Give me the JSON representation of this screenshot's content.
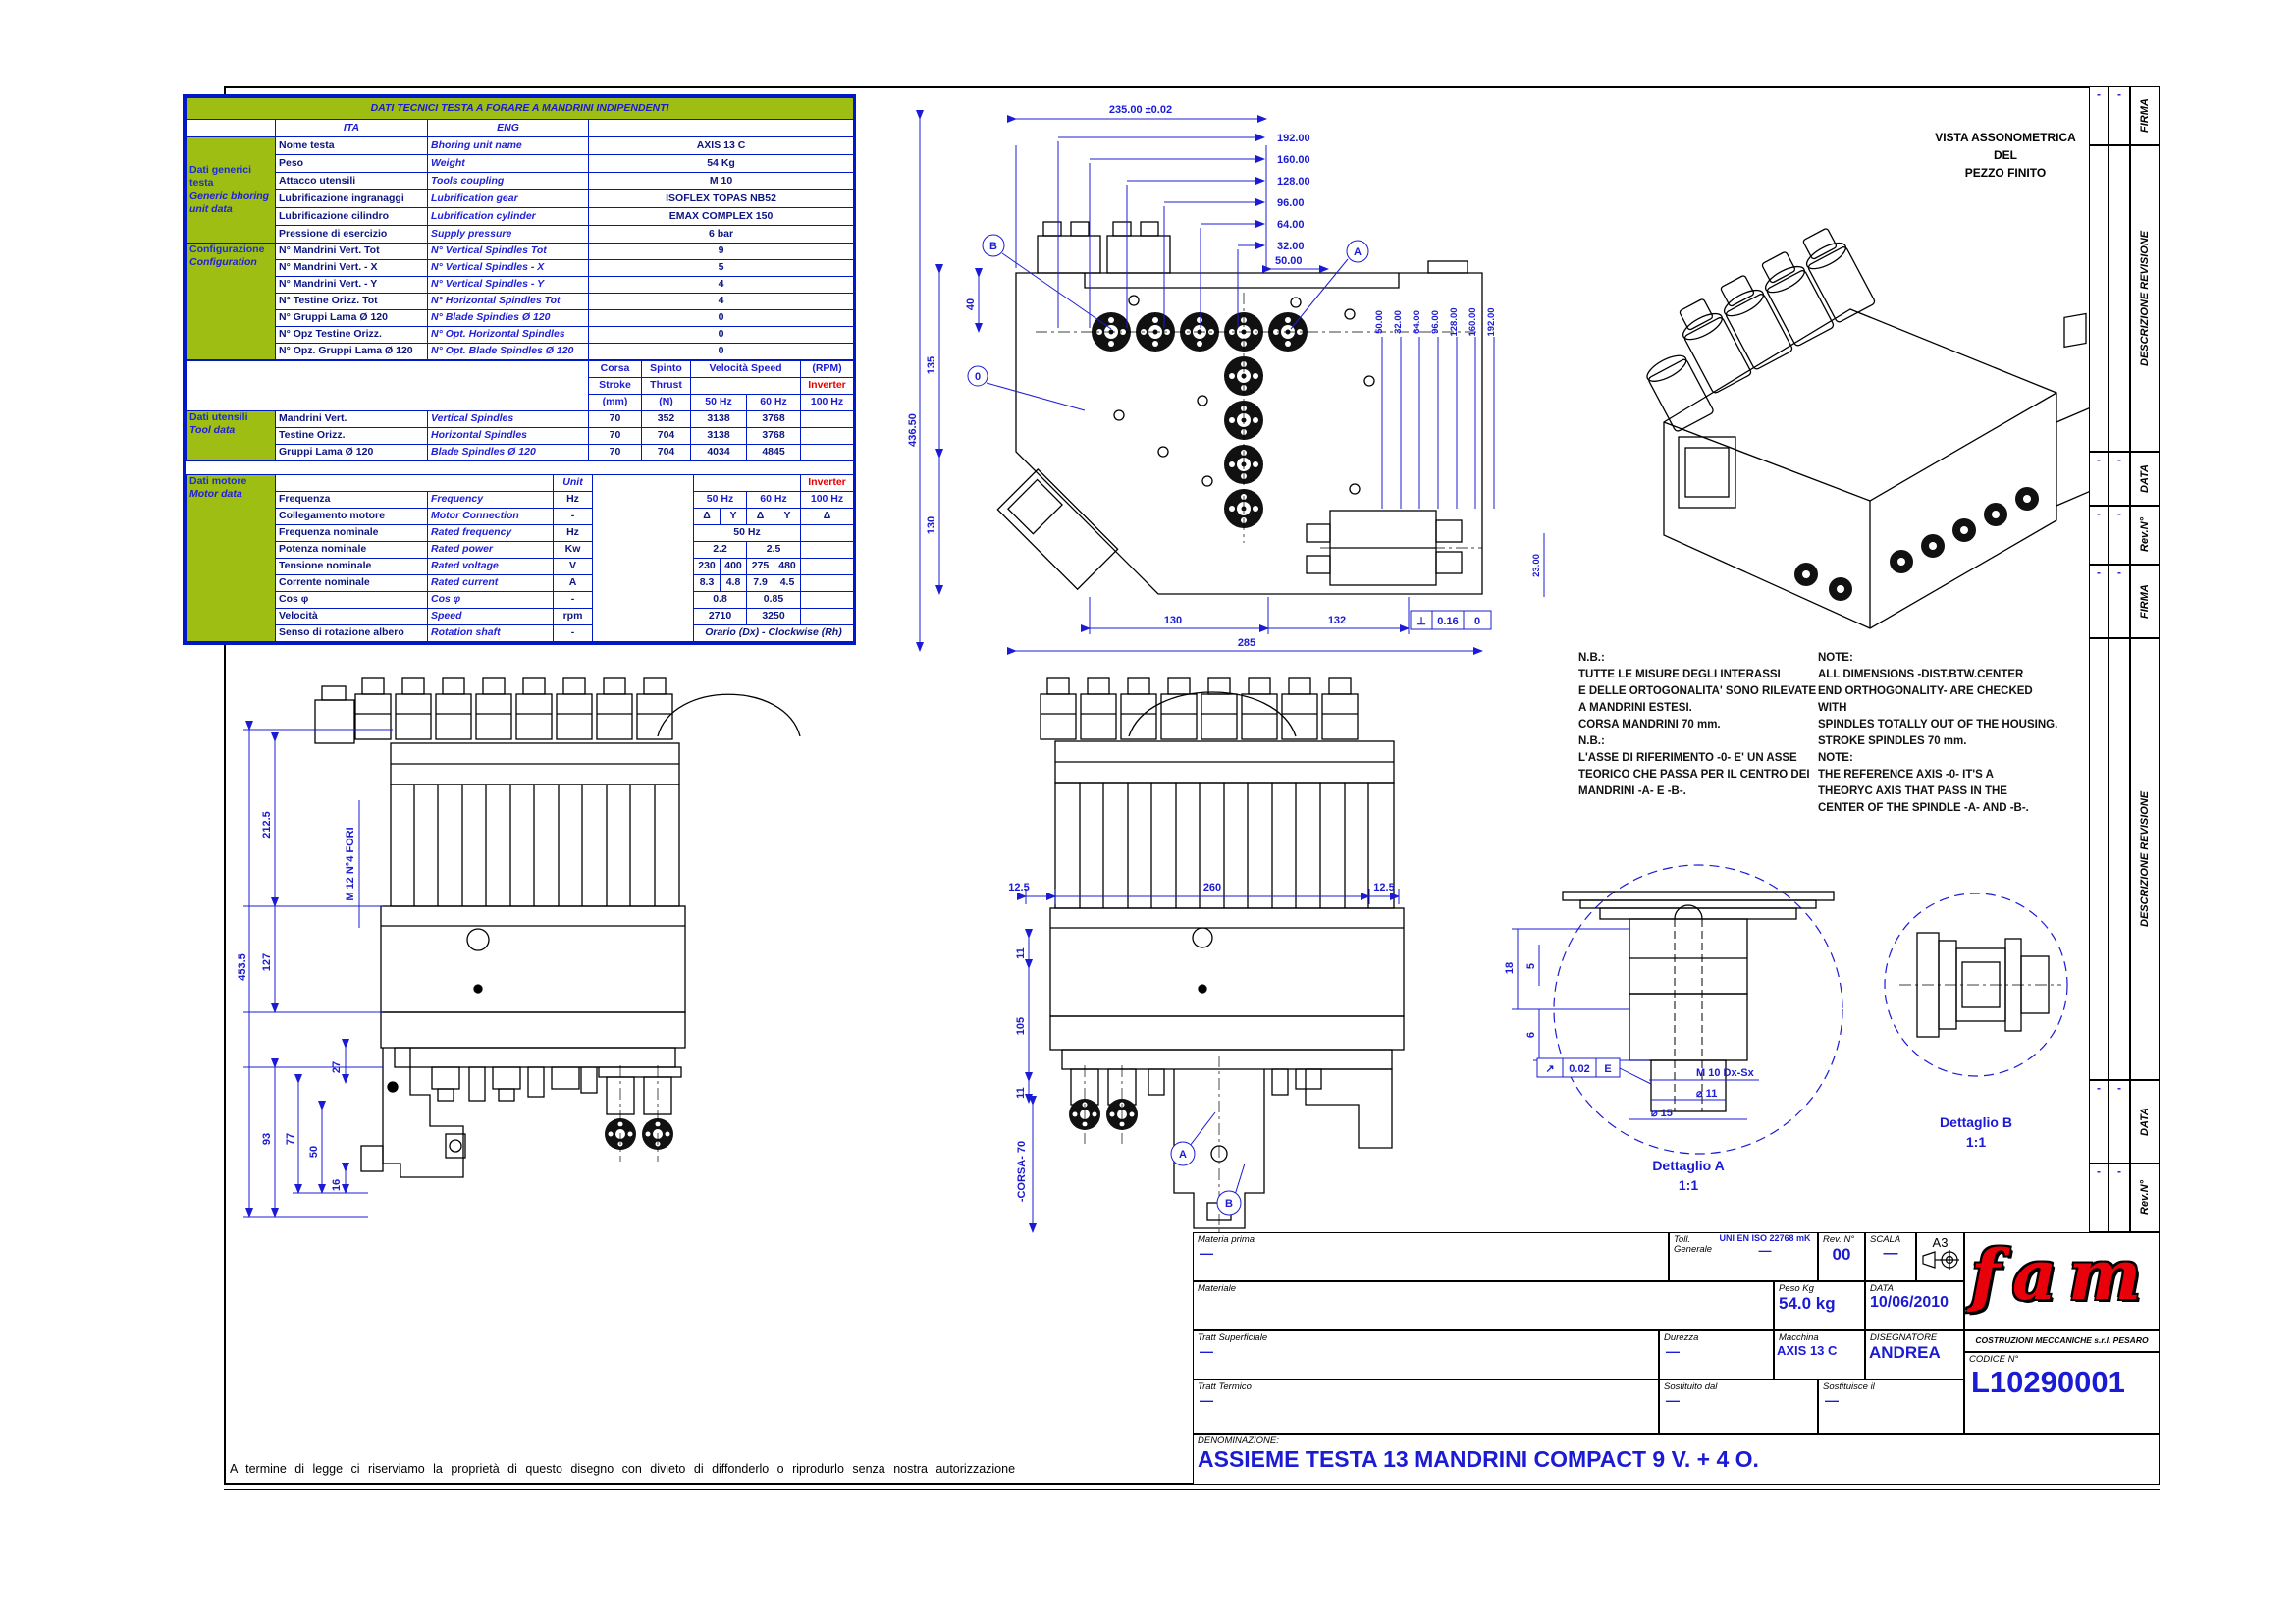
{
  "colors": {
    "green": "#9fbe13",
    "line_blue": "#0018c8",
    "text_blue": "#1b1bd4",
    "red": "#e60000"
  },
  "frame": {
    "footer": "A termine di legge ci riserviamo la proprietà di questo disegno con divieto di diffonderlo o riprodurlo senza nostra autorizzazione"
  },
  "revstrip": {
    "firma": "FIRMA",
    "descr": "DESCRIZIONE REVISIONE",
    "data": "DATA",
    "rev": "Rev.N°",
    "dash": "-"
  },
  "table": {
    "title": "DATI TECNICI TESTA A FORARE A MANDRINI INDIPENDENTI",
    "hdr": {
      "ita": "ITA",
      "eng": "ENG"
    },
    "sections": {
      "generic_it": "Dati generici testa",
      "generic_en": "Generic bhoring unit data",
      "config_it": "Configurazione",
      "config_en": "Configuration",
      "tool_it": "Dati utensili",
      "tool_en": "Tool data",
      "motor_it": "Dati motore",
      "motor_en": "Motor data"
    },
    "generic": [
      {
        "i": "Nome testa",
        "e": "Bhoring unit name",
        "v": "AXIS 13 C"
      },
      {
        "i": "Peso",
        "e": "Weight",
        "v": "54 Kg"
      },
      {
        "i": "Attacco utensili",
        "e": "Tools coupling",
        "v": "M 10"
      },
      {
        "i": "Lubrificazione ingranaggi",
        "e": "Lubrification gear",
        "v": "ISOFLEX TOPAS NB52"
      },
      {
        "i": "Lubrificazione cilindro",
        "e": "Lubrification cylinder",
        "v": "EMAX COMPLEX 150"
      },
      {
        "i": "Pressione di esercizio",
        "e": "Supply pressure",
        "v": "6 bar"
      }
    ],
    "config": [
      {
        "i": "N° Mandrini Vert. Tot",
        "e": "N° Vertical Spindles Tot",
        "v": "9"
      },
      {
        "i": "N° Mandrini Vert. - X",
        "e": "N° Vertical Spindles - X",
        "v": "5"
      },
      {
        "i": "N° Mandrini Vert. - Y",
        "e": "N° Vertical Spindles - Y",
        "v": "4"
      },
      {
        "i": "N° Testine Orizz. Tot",
        "e": "N° Horizontal Spindles Tot",
        "v": "4"
      },
      {
        "i": "N° Gruppi Lama Ø 120",
        "e": "N° Blade Spindles Ø 120",
        "v": "0"
      },
      {
        "i": "N° Opz Testine Orizz.",
        "e": "N° Opt. Horizontal Spindles",
        "v": "0"
      },
      {
        "i": "N° Opz. Gruppi Lama Ø 120",
        "e": "N° Opt. Blade Spindles Ø 120",
        "v": "0"
      }
    ],
    "tool_hdr": {
      "corsa": "Corsa",
      "stroke": "Stroke",
      "mm": "(mm)",
      "spinto": "Spinto",
      "thrust": "Thrust",
      "n": "(N)",
      "vel": "Velocità Speed",
      "rpm": "(RPM)",
      "inv": "Inverter",
      "h50": "50 Hz",
      "h60": "60 Hz",
      "h100": "100 Hz"
    },
    "tool": [
      {
        "i": "Mandrini Vert.",
        "e": "Vertical Spindles",
        "corsa": "70",
        "spinto": "352",
        "v50": "3138",
        "v60": "3768"
      },
      {
        "i": "Testine Orizz.",
        "e": "Horizontal Spindles",
        "corsa": "70",
        "spinto": "704",
        "v50": "3138",
        "v60": "3768"
      },
      {
        "i": "Gruppi Lama Ø 120",
        "e": "Blade Spindles Ø 120",
        "corsa": "70",
        "spinto": "704",
        "v50": "4034",
        "v60": "4845"
      }
    ],
    "unit_label": "Unit",
    "inverter": "Inverter",
    "motor_hdr": {
      "h50": "50 Hz",
      "h60": "60 Hz",
      "h100": "100 Hz"
    },
    "motor": {
      "r1": {
        "i": "Frequenza",
        "e": "Frequency",
        "u": "Hz"
      },
      "r2": {
        "i": "Collegamento motore",
        "e": "Motor Connection",
        "u": "-",
        "d": "Δ",
        "y": "Y"
      },
      "r3": {
        "i": "Frequenza nominale",
        "e": "Rated frequency",
        "u": "Hz",
        "v": "50 Hz"
      },
      "r4": {
        "i": "Potenza nominale",
        "e": "Rated power",
        "u": "Kw",
        "a": "2.2",
        "b": "2.5"
      },
      "r5": {
        "i": "Tensione nominale",
        "e": "Rated voltage",
        "u": "V",
        "a": "230",
        "b": "400",
        "c": "275",
        "d": "480"
      },
      "r6": {
        "i": "Corrente nominale",
        "e": "Rated current",
        "u": "A",
        "a": "8.3",
        "b": "4.8",
        "c": "7.9",
        "d": "4.5"
      },
      "r7": {
        "i": "Cos φ",
        "e": "Cos φ",
        "u": "-",
        "a": "0.8",
        "b": "0.85"
      },
      "r8": {
        "i": "Velocità",
        "e": "Speed",
        "u": "rpm",
        "a": "2710",
        "b": "3250"
      },
      "r9": {
        "i": "Senso di rotazione albero",
        "e": "Rotation shaft",
        "u": "-",
        "v": "Orario (Dx) - Clockwise (Rh)"
      }
    }
  },
  "views": {
    "top": {
      "dim_overall_top": "235.00 ±0.02",
      "cascade": [
        "192.00",
        "160.00",
        "128.00",
        "96.00",
        "64.00",
        "32.00"
      ],
      "dim50": "50.00",
      "left": {
        "d40": "40",
        "d135": "135",
        "d130": "130",
        "overall": "436.50"
      },
      "bottom": {
        "d130": "130",
        "d132": "132",
        "d285": "285"
      },
      "right_cascade": [
        "50.00",
        "32.00",
        "64.00",
        "96.00",
        "128.00",
        "160.00",
        "192.00"
      ],
      "d23": "23.00",
      "balloon_a": "A",
      "balloon_b": "B",
      "balloon_0": "0",
      "tol": {
        "sym": "⊥",
        "val": "0.16",
        "datum": "0"
      }
    },
    "front_left": {
      "overall": "453.5",
      "d2125": "212.5",
      "d127": "127",
      "d93": "93",
      "d77": "77",
      "d50": "50",
      "d27": "27",
      "d16": "16",
      "note": "M 12 N°4 FORI"
    },
    "front_mid": {
      "d125a": "12.5",
      "d260": "260",
      "d125b": "12.5",
      "d11a": "11",
      "d105": "105",
      "d11b": "11",
      "corsa": "-CORSA- 70",
      "balloon_a": "A",
      "balloon_b": "B"
    },
    "det_a": {
      "caption": "Dettaglio A",
      "scale": "1:1",
      "d18": "18",
      "d5": "5",
      "d6": "6",
      "thread": "M 10 Dx-Sx",
      "dia11": "⌀ 11",
      "dia15": "⌀ 15",
      "tol_sym": "↗",
      "tol_val": "0.02",
      "tol_datum": "E"
    },
    "det_b": {
      "caption": "Dettaglio B",
      "scale": "1:1"
    },
    "iso": {
      "caption1": "VISTA ASSONOMETRICA",
      "caption2": "DEL",
      "caption3": "PEZZO FINITO"
    }
  },
  "notes": {
    "it": [
      "N.B.:",
      "TUTTE LE MISURE DEGLI INTERASSI",
      "E DELLE ORTOGONALITA' SONO RILEVATE",
      "A MANDRINI ESTESI.",
      "CORSA MANDRINI 70 mm.",
      "N.B.:",
      "L'ASSE DI RIFERIMENTO -0- E' UN ASSE",
      "TEORICO CHE PASSA PER IL CENTRO DEI",
      "MANDRINI -A- E -B-."
    ],
    "en": [
      "NOTE:",
      "ALL DIMENSIONS -DIST.BTW.CENTER",
      "END ORTHOGONALITY- ARE CHECKED",
      "WITH",
      "SPINDLES TOTALLY OUT OF THE HOUSING.",
      "STROKE SPINDLES 70 mm.",
      "NOTE:",
      "THE REFERENCE AXIS -0- IT'S A",
      "THEORYC AXIS THAT PASS IN THE",
      "CENTER OF THE SPINDLE -A- AND -B-."
    ]
  },
  "titleblock": {
    "materia_prima_l": "Materia prima",
    "materia_prima_v": "—",
    "toll_l1": "Toll.",
    "toll_l2": "Generale",
    "toll_v1": "UNI EN ISO 22768 mK",
    "toll_v2": "—",
    "rev_l": "Rev. N°",
    "rev_v": "00",
    "scala_l": "SCALA",
    "scala_v": "—",
    "formato": "A3",
    "materiale_l": "Materiale",
    "peso_l": "Peso Kg",
    "peso_v": "54.0 kg",
    "data_l": "DATA",
    "data_v": "10/06/2010",
    "tratt_sup_l": "Tratt Superficiale",
    "tratt_sup_v": "—",
    "durezza_l": "Durezza",
    "durezza_v": "—",
    "macchina_l": "Macchina",
    "macchina_v": "AXIS 13 C",
    "disegnatore_l": "DISEGNATORE",
    "disegnatore_v": "ANDREA",
    "logo": "fam",
    "company": "COSTRUZIONI MECCANICHE s.r.l. PESARO",
    "codice_l": "CODICE N°",
    "codice_v": "L10290001",
    "tratt_term_l": "Tratt Termico",
    "tratt_term_v": "—",
    "sost_dal_l": "Sostituito dal",
    "sost_dal_v": "—",
    "sost_il_l": "Sostituisce il",
    "sost_il_v": "—",
    "denom_l": "DENOMINAZIONE:",
    "denom_v": "ASSIEME TESTA 13 MANDRINI COMPACT 9 V. + 4 O."
  }
}
